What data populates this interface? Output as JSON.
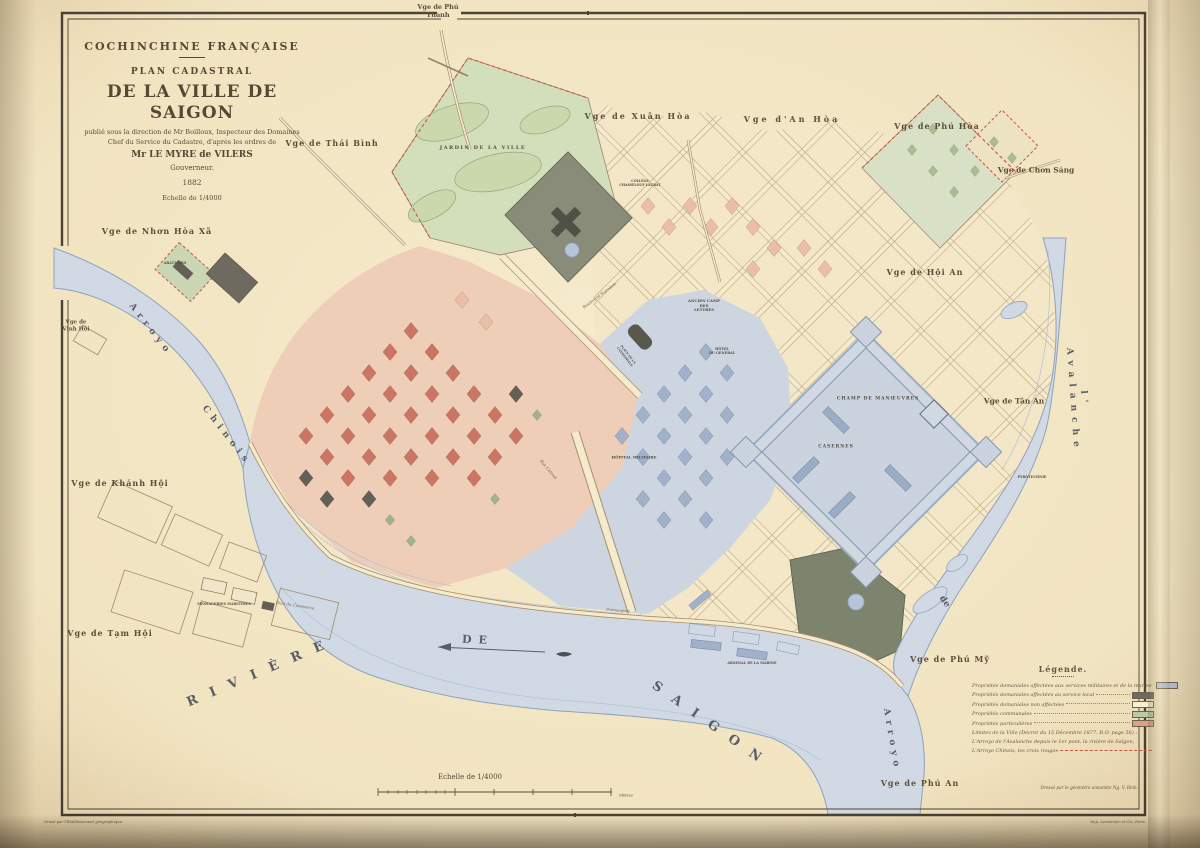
{
  "title_block": {
    "line1": "COCHINCHINE FRANÇAISE",
    "line2": "PLAN CADASTRAL",
    "line3": "DE LA VILLE DE SAIGON",
    "line4": "publié sous la direction de Mr Boilloux, Inspecteur des Domaines",
    "line5": "Chef du Service du Cadastre, d'après les ordres de",
    "line6": "Mr LE MYRE de VILERS",
    "line7": "Gouverneur.",
    "line8": "1882",
    "scale": "Echelle de 1/4000"
  },
  "legend": {
    "title": "Légende.",
    "items": [
      {
        "label": "Propriétés domaniales affectées aux services militaires et de la marine",
        "color": "#a8bcd4"
      },
      {
        "label": "Propriétés domaniales affectées au service local",
        "color": "#57534b"
      },
      {
        "label": "Propriétés domaniales non affectées",
        "color": "#f6ecd2"
      },
      {
        "label": "Propriétés communales",
        "color": "#aec49a"
      },
      {
        "label": "Propriétés particulières",
        "color": "#dd8f7e"
      }
    ],
    "notes": [
      {
        "text": "Limites de la Ville (Décret du 15 Décembre 1877, B.O. page 56) :",
        "dash": false
      },
      {
        "text": "L'Arroyo de l'Avalanche depuis le 1er pont, la rivière de Saïgon,",
        "dash": false
      },
      {
        "text": "L'Arroyo Chinois, les croix rouges",
        "dash": true
      }
    ]
  },
  "scale_bar": {
    "label": "Echelle de 1/4000",
    "unit": "Mètres"
  },
  "credits": {
    "drafted": "Dressé par le géomètre annamite Ng. V. Binh.",
    "engraved": "Gravé par l'Établissement géographique.",
    "printed": "Imp. Lemercier et Cie, Paris."
  },
  "map_labels": [
    {
      "id": "phu-thanh",
      "cls": "vg",
      "text": "Vge de Phú\nThanh",
      "x": 438,
      "y": 12,
      "s": 6.5
    },
    {
      "id": "thai-binh",
      "cls": "vg",
      "text": "Vge de Thái Bình",
      "x": 332,
      "y": 144,
      "s": 8,
      "ls": 1
    },
    {
      "id": "nhon-hoa-xa",
      "cls": "vg",
      "text": "Vge de Nhơn Hòa Xã",
      "x": 157,
      "y": 232,
      "s": 8,
      "ls": 1
    },
    {
      "id": "vinh-hoi",
      "cls": "vg",
      "text": "Vge de\nVinh Hội",
      "x": 76,
      "y": 326,
      "s": 5.5
    },
    {
      "id": "khanh-hoi",
      "cls": "vg",
      "text": "Vge de Khánh Hội",
      "x": 120,
      "y": 484,
      "s": 8,
      "ls": 1
    },
    {
      "id": "tam-hoi",
      "cls": "vg",
      "text": "Vge de Tạm Hội",
      "x": 110,
      "y": 634,
      "s": 8,
      "ls": 1
    },
    {
      "id": "xuan-hoa",
      "cls": "vg",
      "text": "Vge de Xuân Hòa",
      "x": 638,
      "y": 117,
      "s": 8,
      "ls": 2
    },
    {
      "id": "an-hoa",
      "cls": "vg",
      "text": "Vge d'An Hòa",
      "x": 792,
      "y": 120,
      "s": 8,
      "ls": 3
    },
    {
      "id": "phu-hoa",
      "cls": "vg",
      "text": "Vge de Phú Hòa",
      "x": 937,
      "y": 127,
      "s": 8,
      "ls": 1
    },
    {
      "id": "chon-sang",
      "cls": "vg",
      "text": "Vge de Chơn Sáng",
      "x": 1036,
      "y": 170,
      "s": 7.5
    },
    {
      "id": "hoi-an",
      "cls": "vg",
      "text": "Vge de Hội An",
      "x": 925,
      "y": 273,
      "s": 8,
      "ls": 1
    },
    {
      "id": "tan-an",
      "cls": "vg",
      "text": "Vge de Tân An",
      "x": 1014,
      "y": 401,
      "s": 7.5
    },
    {
      "id": "phu-my",
      "cls": "vg",
      "text": "Vge de Phú Mỹ",
      "x": 950,
      "y": 660,
      "s": 8,
      "ls": 1
    },
    {
      "id": "phu-an",
      "cls": "vg",
      "text": "Vge de Phú An",
      "x": 920,
      "y": 784,
      "s": 8,
      "ls": 1
    },
    {
      "id": "riviere",
      "cls": "wt",
      "text": "RIVIÈRE",
      "x": 262,
      "y": 672,
      "s": 13,
      "r": -23,
      "ls": 14
    },
    {
      "id": "de",
      "cls": "wt",
      "text": "DE",
      "x": 478,
      "y": 640,
      "s": 11,
      "r": 3,
      "ls": 7
    },
    {
      "id": "saigon",
      "cls": "wt",
      "text": "SAIGON",
      "x": 712,
      "y": 726,
      "s": 13,
      "r": 35,
      "ls": 14
    },
    {
      "id": "arroyo-w",
      "cls": "wt",
      "text": "Arroyo",
      "x": 150,
      "y": 330,
      "s": 9,
      "r": 52,
      "ls": 5
    },
    {
      "id": "chinois",
      "cls": "wt",
      "text": "Chinois",
      "x": 226,
      "y": 436,
      "s": 9,
      "r": 52,
      "ls": 5
    },
    {
      "id": "avalanche",
      "cls": "wt",
      "text": "l' Avalanche",
      "x": 1078,
      "y": 400,
      "s": 9,
      "r": 86,
      "ls": 6
    },
    {
      "id": "arroyo-e",
      "cls": "wt",
      "text": "Arroyo",
      "x": 891,
      "y": 740,
      "s": 9,
      "r": 80,
      "ls": 5
    },
    {
      "id": "de-e",
      "cls": "wt",
      "text": "de",
      "x": 944,
      "y": 602,
      "s": 9,
      "r": 55
    },
    {
      "id": "jardin",
      "cls": "bl",
      "text": "JARDIN DE LA VILLE",
      "x": 483,
      "y": 148,
      "s": 5,
      "ls": 1.5
    },
    {
      "id": "college",
      "cls": "bl",
      "text": "COLLÈGE\nCHASSELOUP LAUBAT",
      "x": 640,
      "y": 184,
      "s": 3.2
    },
    {
      "id": "camp-lettres",
      "cls": "bl",
      "text": "ANCIEN CAMP\nDES\nLETTRÉS",
      "x": 704,
      "y": 306,
      "s": 3.8
    },
    {
      "id": "hotel-general",
      "cls": "bl",
      "text": "HÔTEL\nDU GÉNÉRAL",
      "x": 722,
      "y": 351,
      "s": 3.4
    },
    {
      "id": "champ-manoeuvres",
      "cls": "bl",
      "text": "CHAMP DE MANŒUVRES",
      "x": 878,
      "y": 399,
      "s": 4.4,
      "ls": 1
    },
    {
      "id": "casernes",
      "cls": "bl",
      "text": "CASERNES",
      "x": 836,
      "y": 447,
      "s": 4.4,
      "ls": 1
    },
    {
      "id": "hopital",
      "cls": "bl",
      "text": "HÔPITAL MILITAIRE",
      "x": 634,
      "y": 458,
      "s": 3.8
    },
    {
      "id": "arsenal",
      "cls": "bl",
      "text": "ARSENAL DE LA MARINE",
      "x": 752,
      "y": 663,
      "s": 3.4
    },
    {
      "id": "messageries",
      "cls": "bl",
      "text": "MESSAGERIES MARITIMES",
      "x": 224,
      "y": 604,
      "s": 3.4
    },
    {
      "id": "abattoirs",
      "cls": "bl",
      "text": "ABATTOIRS",
      "x": 175,
      "y": 263,
      "s": 3.4
    },
    {
      "id": "pyrotechnie",
      "cls": "bl",
      "text": "PYROTECHNIE",
      "x": 1032,
      "y": 477,
      "s": 3.4
    },
    {
      "id": "place-cathedrale",
      "cls": "bl",
      "text": "PLACE DE LA\nCATHÉDRALE",
      "x": 626,
      "y": 356,
      "s": 3,
      "r": 52
    },
    {
      "id": "quai-commerce",
      "cls": "st",
      "text": "Quai du Commerce",
      "x": 295,
      "y": 606,
      "s": 4,
      "r": 9
    },
    {
      "id": "primauguet",
      "cls": "st",
      "text": "Primauguet",
      "x": 618,
      "y": 611,
      "s": 4,
      "r": 4
    },
    {
      "id": "norodom",
      "cls": "st",
      "text": "Boulevard Norodom",
      "x": 600,
      "y": 296,
      "s": 4,
      "r": -37
    },
    {
      "id": "catinat",
      "cls": "st",
      "text": "Rue Catinat",
      "x": 548,
      "y": 470,
      "s": 4,
      "r": 50
    },
    {
      "id": "echelle-bottom",
      "cls": "sc",
      "text": "Echelle de 1/4000",
      "x": 470,
      "y": 777,
      "s": 7
    },
    {
      "id": "metres",
      "cls": "sc",
      "text": "Mètres",
      "x": 626,
      "y": 796,
      "s": 3.8
    }
  ]
}
